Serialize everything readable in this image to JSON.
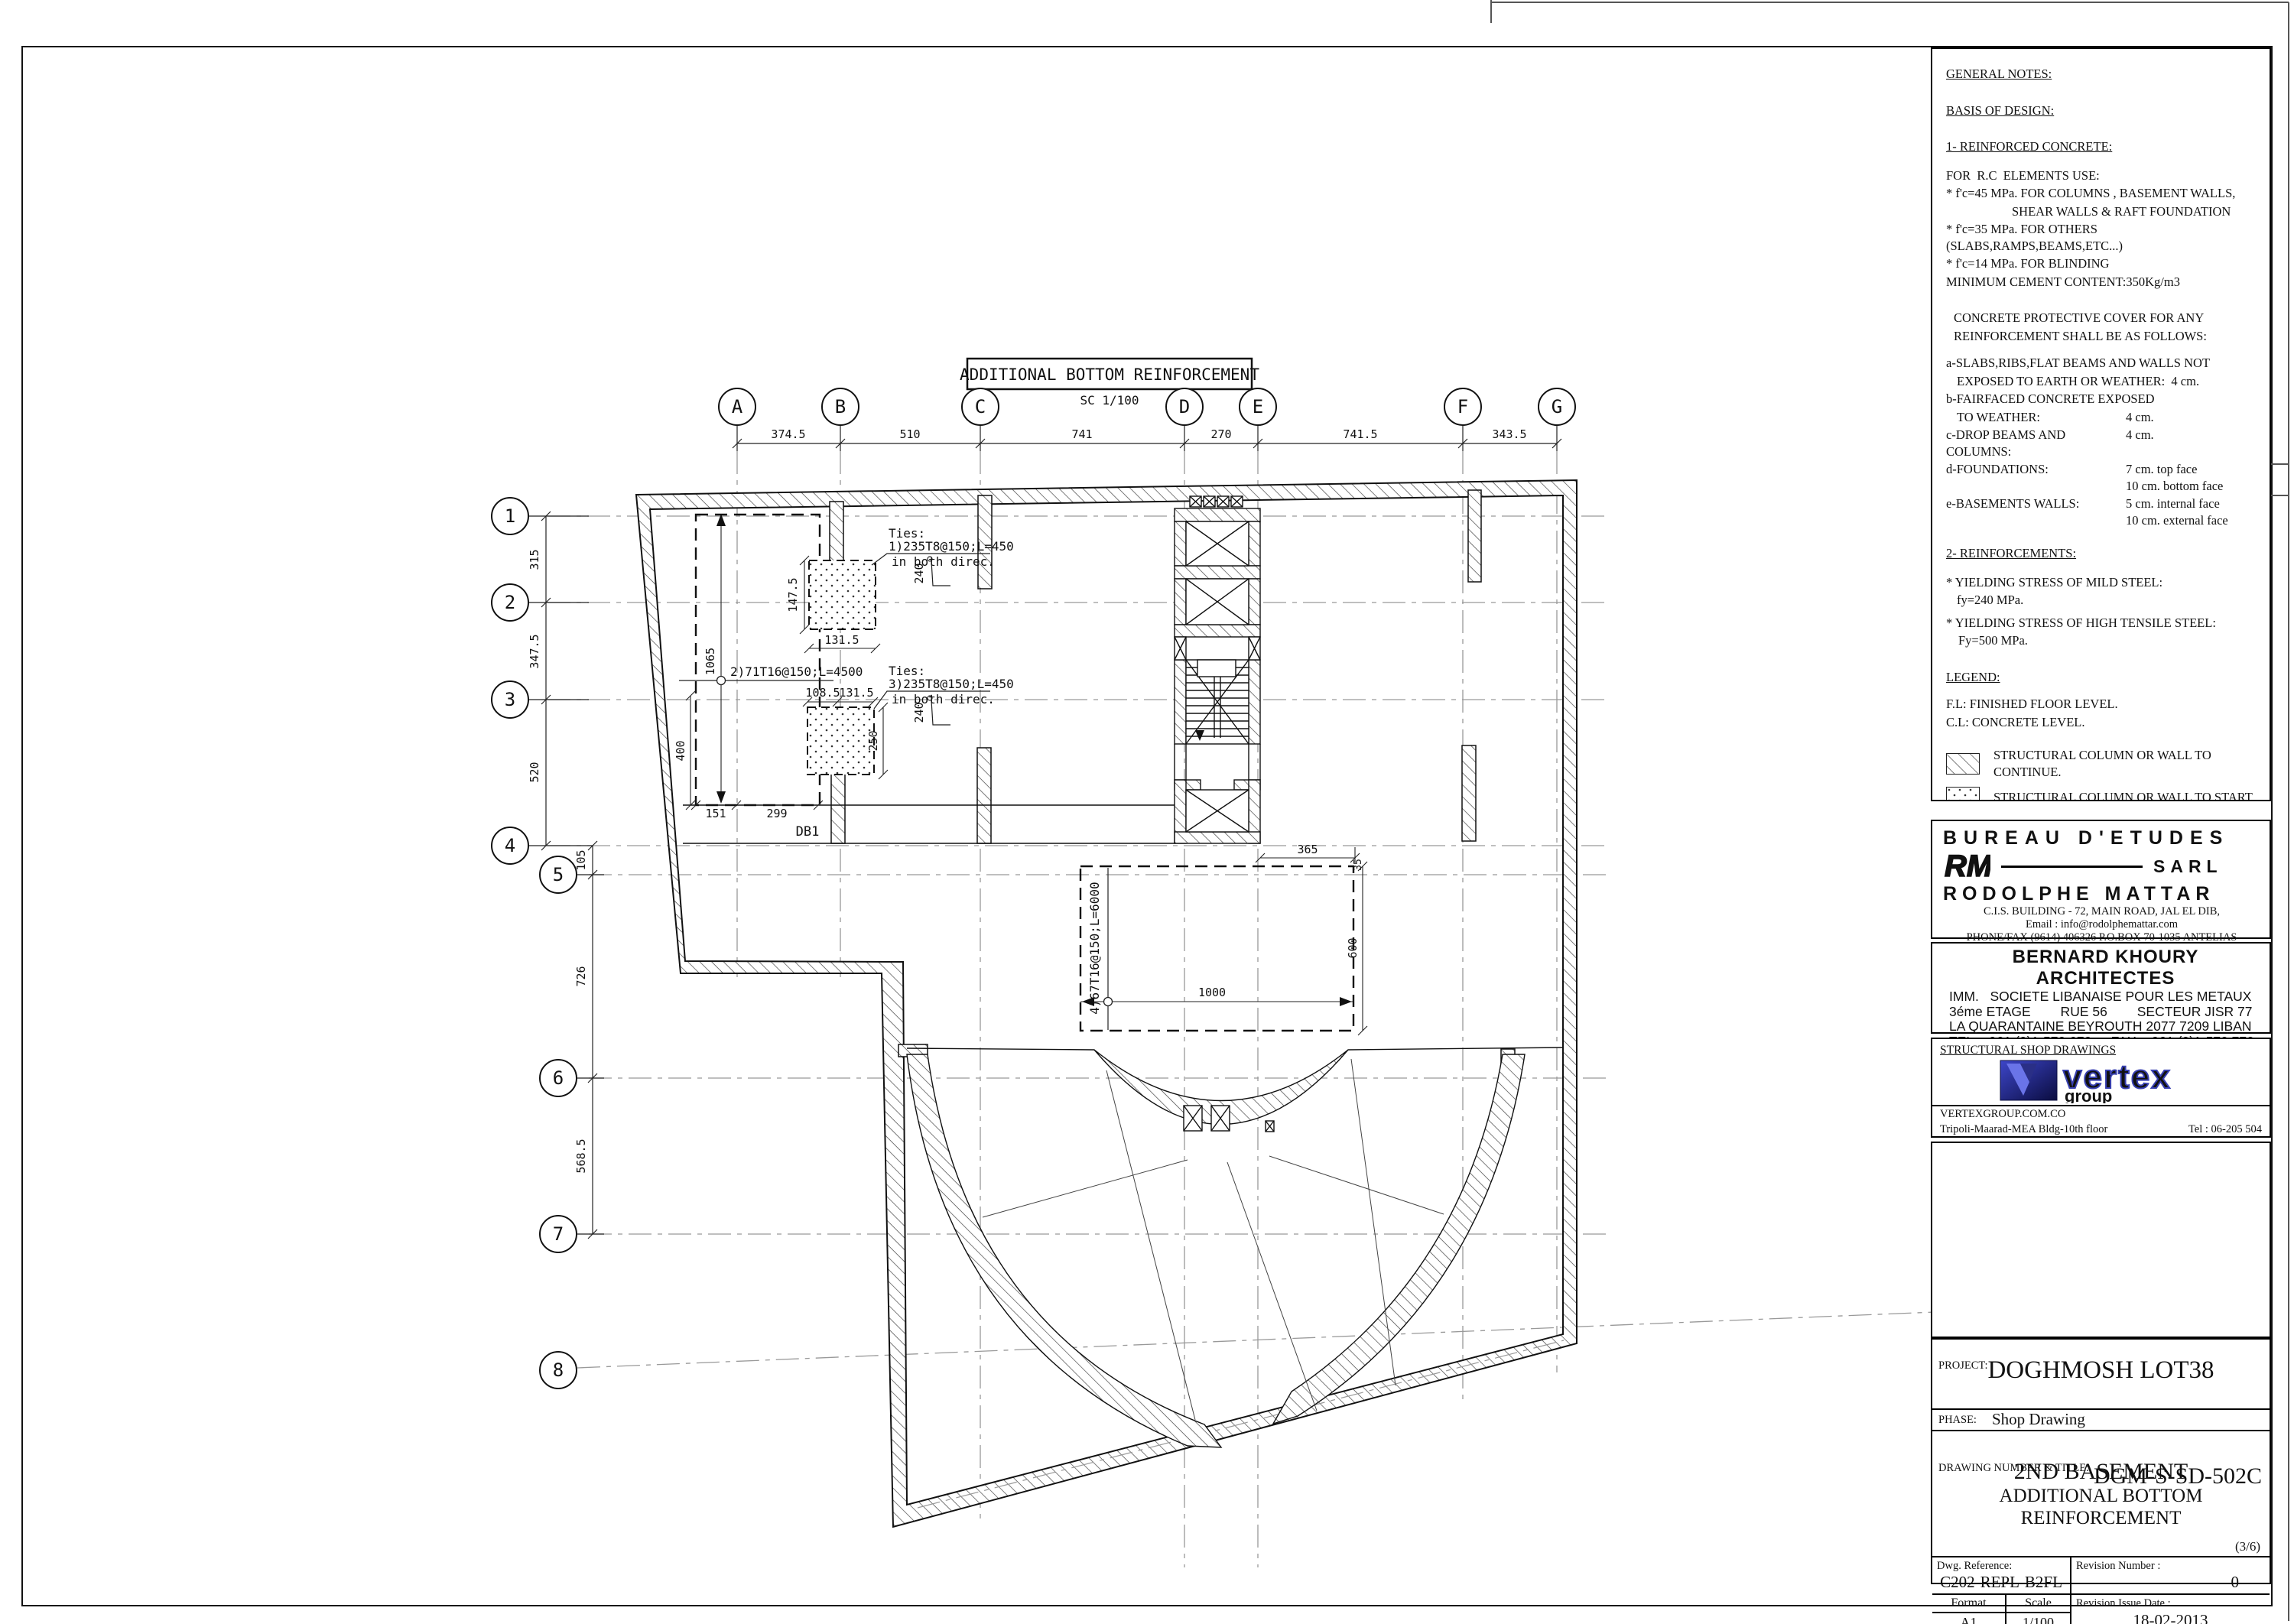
{
  "plan": {
    "title": "ADDITIONAL BOTTOM REINFORCEMENT",
    "scale_label": "SC 1/100",
    "grid": {
      "cols": [
        "A",
        "B",
        "C",
        "D",
        "E",
        "F",
        "G"
      ],
      "col_dims": [
        "374.5",
        "510",
        "741",
        "270",
        "741.5",
        "343.5"
      ],
      "rows": [
        "1",
        "2",
        "3",
        "4",
        "5",
        "6",
        "7",
        "8"
      ],
      "row_dims": [
        "315",
        "347.5",
        "520",
        "105",
        "726",
        "568.5"
      ]
    },
    "annotations": {
      "ties1_l1": "Ties:",
      "ties1_l2": "1)235T8@150;L=450",
      "ties1_l3": "in both direc.",
      "ties3_l1": "Ties:",
      "ties3_l2": "3)235T8@150;L=450",
      "ties3_l3": "in both direc.",
      "bar2": "2)71T16@150;L=4500",
      "bar4": "4)67T16@150;L=6000",
      "bent_bar_dim": "240",
      "db1": "DB1"
    },
    "dims": {
      "d1065": "1065",
      "d147_5": "147.5",
      "d131_5a": "131.5",
      "d108_5": "108.5",
      "d131_5b": "131.5",
      "d250": "250",
      "d400": "400",
      "d151": "151",
      "d299": "299",
      "d365": "365",
      "d600": "600",
      "d1000": "1000",
      "d35": "35"
    }
  },
  "notes": {
    "title": "GENERAL NOTES:",
    "basis": "BASIS OF DESIGN:",
    "rc_title": "1- REINFORCED CONCRETE:",
    "use": "FOR  R.C  ELEMENTS USE:",
    "fc45a": "* f'c=45 MPa. FOR COLUMNS , BASEMENT WALLS,",
    "fc45b": "SHEAR WALLS & RAFT FOUNDATION",
    "fc35": "* f'c=35 MPa. FOR OTHERS (SLABS,RAMPS,BEAMS,ETC...)",
    "fc14": "* f'c=14 MPa. FOR BLINDING",
    "cement": "MINIMUM CEMENT CONTENT:350Kg/m3",
    "cover1": "CONCRETE PROTECTIVE COVER FOR ANY",
    "cover2": "REINFORCEMENT SHALL BE AS FOLLOWS:",
    "a1": "a-SLABS,RIBS,FLAT BEAMS AND WALLS NOT",
    "a2": "EXPOSED TO EARTH OR WEATHER:  4 cm.",
    "b1": "b-FAIRFACED CONCRETE EXPOSED",
    "b2_label": "TO WEATHER:",
    "b2_val": "4 cm.",
    "c_label": "c-DROP BEAMS AND COLUMNS:",
    "c_val": "4 cm.",
    "d_label": "d-FOUNDATIONS:",
    "d_val1": "7 cm. top face",
    "d_val2": "10 cm. bottom face",
    "e_label": "e-BASEMENTS WALLS:",
    "e_val1": "5 cm. internal face",
    "e_val2": "10 cm. external face",
    "reinf_title": "2- REINFORCEMENTS:",
    "mild1": "* YIELDING STRESS OF MILD STEEL:",
    "mild2": "fy=240 MPa.",
    "ht1": "* YIELDING STRESS OF HIGH TENSILE STEEL:",
    "ht2": "Fy=500 MPa."
  },
  "legend": {
    "title": "LEGEND:",
    "fl": "F.L: FINISHED FLOOR LEVEL.",
    "cl": "C.L: CONCRETE LEVEL.",
    "items": [
      {
        "label": "STRUCTURAL COLUMN OR WALL TO CONTINUE."
      },
      {
        "label": "STRUCTURAL COLUMN OR WALL TO START."
      },
      {
        "label": "STRUCTURAL COLUMN OR WALL TO STOP."
      },
      {
        "label": "ARCHITECTURAL COLUMN OR WALL."
      },
      {
        "label": "SUNKEN SLAB."
      }
    ]
  },
  "bureau": {
    "line1": "BUREAU D'ETUDES",
    "logo": "RM",
    "sarl": "SARL",
    "name": "RODOLPHE MATTAR",
    "addr1": "C.I.S. BUILDING - 72, MAIN ROAD, JAL EL DIB,",
    "addr2": "Email : info@rodolphemattar.com",
    "addr3": "PHONE/FAX (9614) 406326 P.O.BOX 70-1035 ANTELIAS LEBANON"
  },
  "architect": {
    "name": "BERNARD KHOURY ARCHITECTES",
    "line1": "IMM.   SOCIETE LIBANAISE POUR LES METAUX",
    "line2": "3éme ETAGE        RUE 56        SECTEUR JISR 77",
    "line3": "LA QUARANTAINE BEYROUTH 2077 7209 LIBAN",
    "line4": "TEL: +961 (0)1-570 670  -  FAX: +961 (0)1-570 770",
    "line5": "E-MAIL:   mailbox @ b e r n a r d k h o u r y . c o m"
  },
  "shop": {
    "heading": "STRUCTURAL SHOP DRAWINGS",
    "logo_text": "vertex",
    "logo_sub": "group",
    "website": "VERTEXGROUP.COM.CO",
    "address": "Tripoli-Maarad-MEA Bldg-10th floor",
    "tel": "Tel : 06-205 504"
  },
  "project": {
    "label": "PROJECT:",
    "name": "DOGHMOSH LOT38",
    "phase_label": "PHASE:",
    "phase": "Shop Drawing",
    "dwg_label": "DRAWING NUMBER & TITLE:",
    "number": "DGM-S-SD-502C",
    "title1": "2ND BASEMENT",
    "title2": "ADDITIONAL BOTTOM",
    "title3": "REINFORCEMENT",
    "sheet_index": "(3/6)",
    "ref_label": "Dwg. Reference:",
    "ref": "C202-REPL-B2FL",
    "rev_label": "Revision Number :",
    "rev": "0",
    "format_label": "Format",
    "format": "A1",
    "scale_label": "Scale",
    "scale": "1/100",
    "date_label": "Revision Issue Date :",
    "date": "18-02-2013"
  }
}
